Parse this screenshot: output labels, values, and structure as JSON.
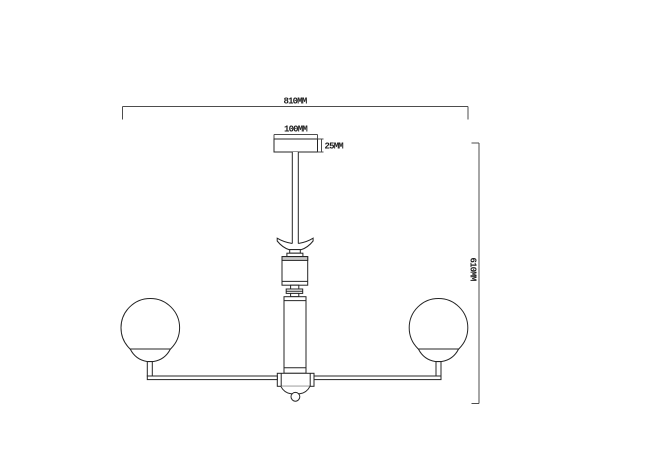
{
  "diagram": {
    "type": "technical-elevation-drawing",
    "subject": "two-light chandelier ceiling fixture with dimension annotations",
    "units": "MM",
    "dimensions": {
      "overall_width": {
        "label": "810MM",
        "value_mm": 810
      },
      "canopy_width": {
        "label": "100MM",
        "value_mm": 100
      },
      "canopy_height": {
        "label": "25MM",
        "value_mm": 25
      },
      "overall_height": {
        "label": "610MM",
        "value_mm": 610
      }
    },
    "colors": {
      "fixture_line": "#242424",
      "dimension_line": "#4d4d4d",
      "shade_band": "#c9c9c9",
      "background": "#ffffff"
    }
  }
}
